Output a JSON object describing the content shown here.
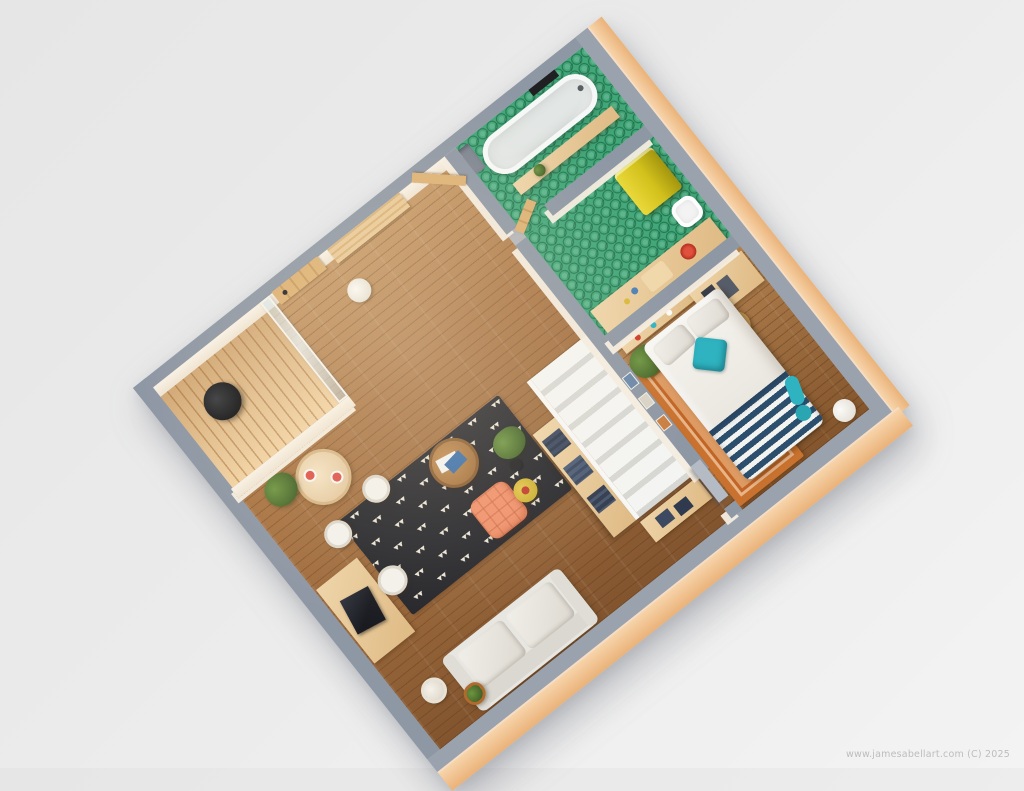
{
  "watermark": {
    "text": "www.jamesabellart.com (C) 2025"
  },
  "scene": {
    "kind": "3D cutaway floor plan render",
    "description": "Top-down isometric render of a one-bedroom apartment, plan rotated about 38 degrees on a grey backdrop",
    "view": {
      "rotation_deg": -38.4,
      "background": "#e9e9e9"
    },
    "rooms": [
      {
        "name": "bathroom",
        "floor": "green hex tile",
        "items": [
          "freestanding-bathtub",
          "wood-shelf",
          "shelf-plant",
          "shower-niche",
          "wall-object"
        ]
      },
      {
        "name": "kitchen-corridor",
        "floor": "green hex tile",
        "items": [
          "yellow-fridge",
          "toilet",
          "kitchen-counter",
          "burner",
          "cutting-board"
        ]
      },
      {
        "name": "bedroom",
        "floor": "wood",
        "items": [
          "double-bed",
          "white-pillows",
          "teal-pillow",
          "navy-striped-blanket",
          "teal-throw",
          "orange-border-rug",
          "desk",
          "wicker-chair",
          "corner-plant",
          "wall-shelf",
          "white-pouf",
          "sliding-door"
        ]
      },
      {
        "name": "living-room",
        "floor": "wood",
        "items": [
          "grey-sofa",
          "triangle-pattern-rug",
          "round-coffee-table",
          "salmon-armchair",
          "yellow-side-table",
          "floor-lamp",
          "palm-plant",
          "white-staircase",
          "bookshelf",
          "sideboard",
          "wall-pictures",
          "white-basket",
          "potted-plant"
        ]
      },
      {
        "name": "entry-dining",
        "floor": "wood",
        "items": [
          "plank-door",
          "open-entry-door",
          "leaning-wood-panels",
          "white-cylinder",
          "round-dining-table",
          "red-plates",
          "ficus-plant",
          "white-chair",
          "white-chair",
          "work-desk",
          "laptop",
          "desk-chair"
        ]
      },
      {
        "name": "balcony",
        "floor": "wood deck slats",
        "items": [
          "black-fire-table",
          "glass-partition"
        ]
      }
    ],
    "palette": {
      "background_grey": "#e9e9e9",
      "wall_top_grey": "#8e97a4",
      "wall_outer_peach": "#f0c79c",
      "wall_inner_cream": "#f6efe3",
      "wood_floor": "#aa7544",
      "bedroom_wood": "#9b6838",
      "balcony_deck": "#ecc791",
      "tile_green": "#41a678",
      "fridge_yellow": "#d4c31e",
      "teal_accent": "#2fb3c0",
      "stripe_navy": "#2c4f6e",
      "rug_cream": "#ebe4d4",
      "rug_orange": "#c9722f",
      "armchair_salmon": "#f0906a",
      "side_table_yellow": "#d4b435",
      "sofa_grey": "#e8e6e1",
      "accent_red": "#cc3b2a",
      "watermark_grey": "#bdbdbd"
    }
  }
}
